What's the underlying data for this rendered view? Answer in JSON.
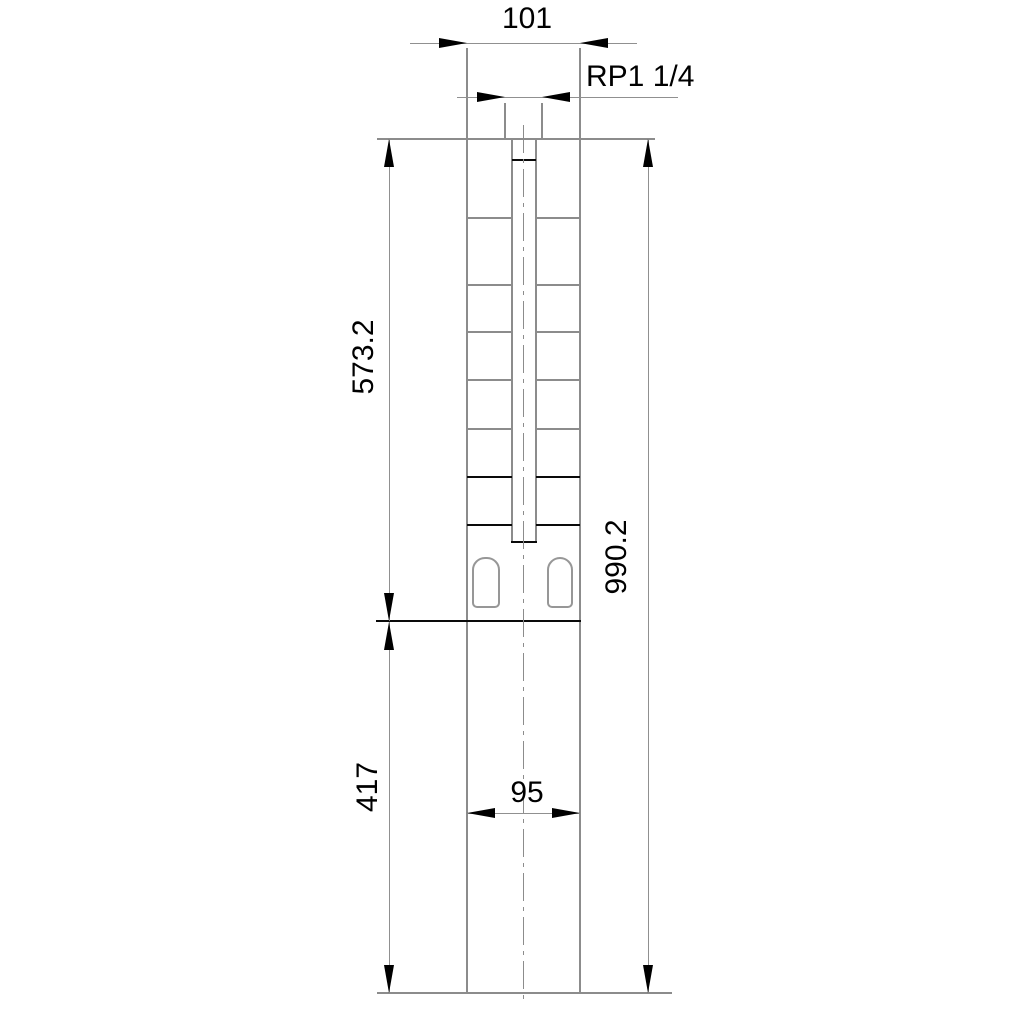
{
  "drawing": {
    "labels": {
      "top_width": "101",
      "thread": "RP1 1/4",
      "upper_length": "573.2",
      "total_length": "990.2",
      "lower_length": "417",
      "lower_width": "95"
    },
    "colors": {
      "background": "#ffffff",
      "line_gray": "#8c8c8c",
      "line_black": "#0a0a0a",
      "text": "#000000"
    }
  }
}
